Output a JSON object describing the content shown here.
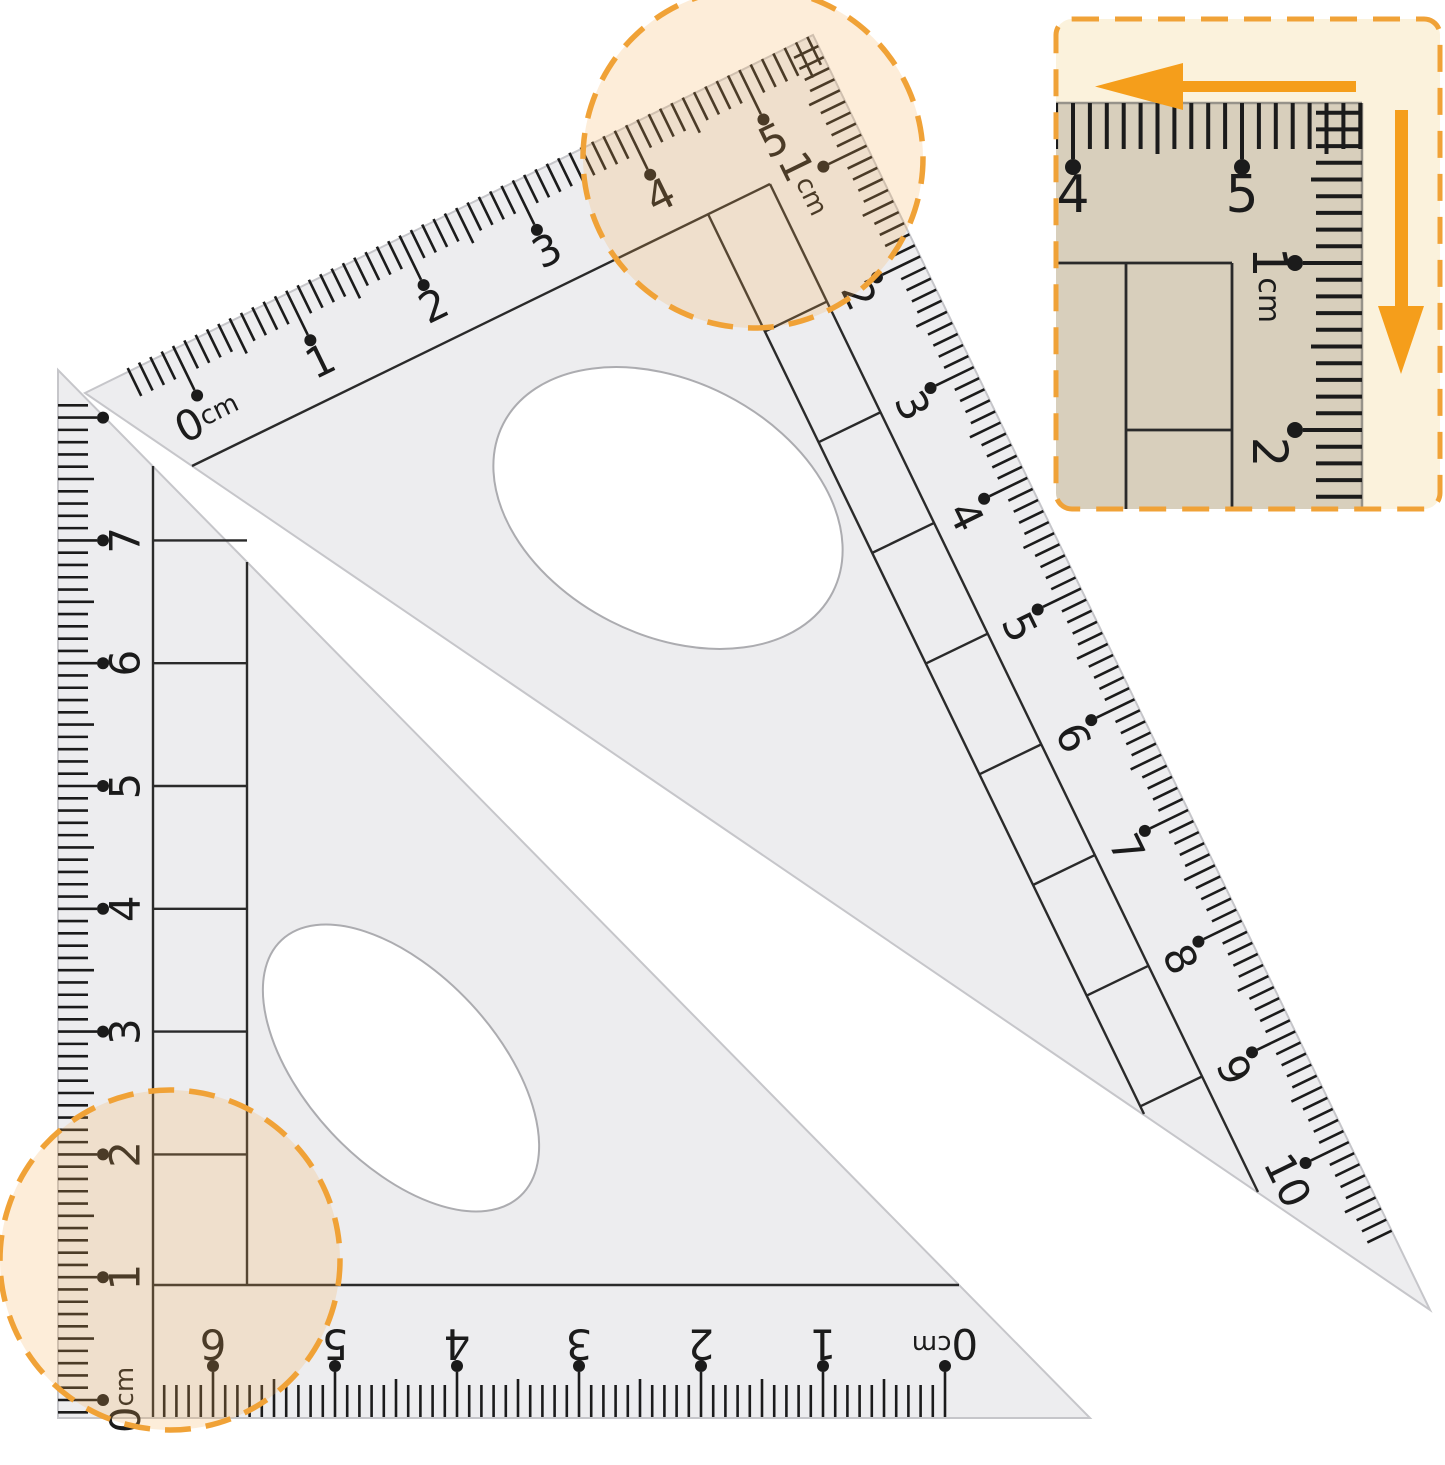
{
  "image_type": "product-photo of two transparent triangle rulers (set squares) with zoom callouts",
  "unit": "cm",
  "colors": {
    "white": "#ffffff",
    "body": "#ededef",
    "body_edge": "#c6c6ca",
    "cutout_stroke": "#acacb0",
    "ink": "#1b1b1b",
    "interior_line": "#2a2a2a",
    "orange": "#f59e1b",
    "dash_orange": "#f0a237",
    "circle_fill": "rgba(246,174,83,0.22)",
    "inset_bg": "#fbf2dc",
    "inset_ruler": "#d8cfbc",
    "inset_ruler_edge": "#97938a"
  },
  "icons": {
    "arrow_left": "left-arrow",
    "arrow_down": "down-arrow"
  },
  "triangle1": {
    "description": "large 30-60-90 set square, scales on top and right edges",
    "top_scale": {
      "labels": [
        "0cm",
        "1",
        "2",
        "3",
        "4",
        "5"
      ]
    },
    "right_scale": {
      "labels": [
        null,
        "1cm",
        "2",
        "3",
        "4",
        "5",
        "6",
        "7",
        "8",
        "9",
        "10"
      ]
    }
  },
  "triangle2": {
    "description": "45-45-90 set square, scales on left and bottom edges",
    "left_scale": {
      "labels": [
        "0cm",
        "1",
        "2",
        "3",
        "4",
        "5",
        "6",
        "7"
      ]
    },
    "bottom_scale": {
      "labels": [
        "0cm",
        "1",
        "2",
        "3",
        "4",
        "5",
        "6"
      ]
    }
  },
  "inset": {
    "description": "magnified corner detail with measuring-direction arrows",
    "top_scale": {
      "labels": [
        "4",
        "5"
      ]
    },
    "right_scale": {
      "labels": [
        "1cm",
        "2"
      ]
    }
  }
}
